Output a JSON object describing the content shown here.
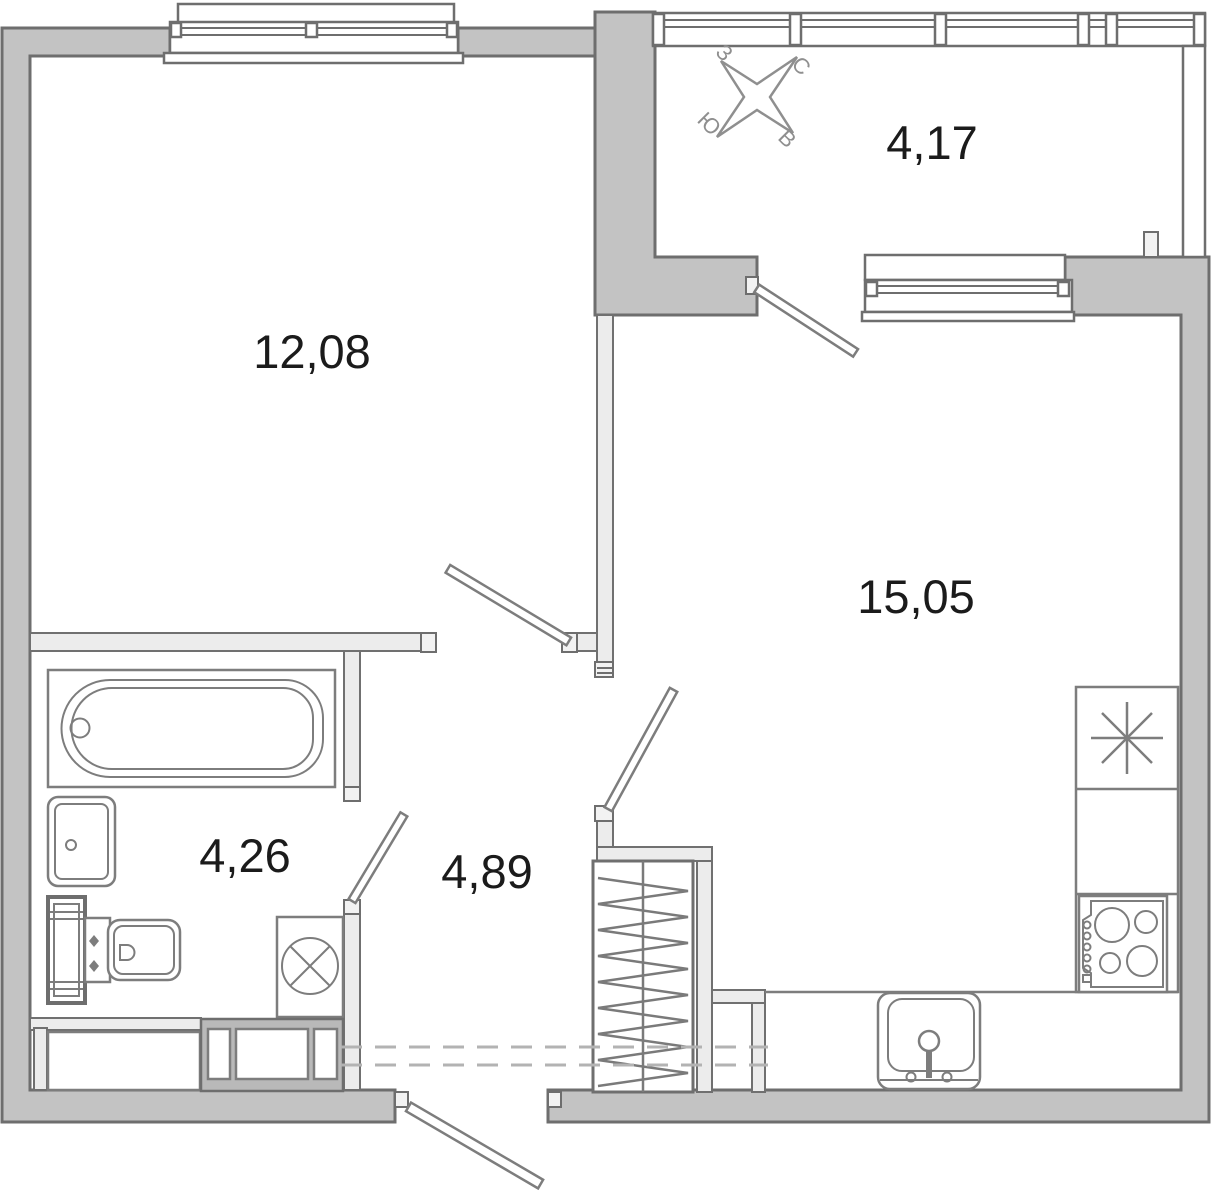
{
  "floor_plan": {
    "rooms": {
      "bedroom": {
        "area": "12,08"
      },
      "balcony": {
        "area": "4,17"
      },
      "living_kitchen": {
        "area": "15,05"
      },
      "bathroom": {
        "area": "4,26"
      },
      "hallway": {
        "area": "4,89"
      }
    },
    "compass": {
      "north": "С",
      "east": "В",
      "south": "Ю",
      "west": "З"
    },
    "colors": {
      "exterior_wall": "#c3c3c3",
      "interior_wall": "#ececec",
      "wall_outline": "#6e6e6e",
      "fixture_line": "#7d7d7d",
      "cabinet_fill": "#b9b9b9",
      "label_text": "#1b1b1b",
      "compass_gray": "#8f8f8f",
      "dashed_line": "#b3b3b3",
      "background": "#ffffff"
    }
  }
}
